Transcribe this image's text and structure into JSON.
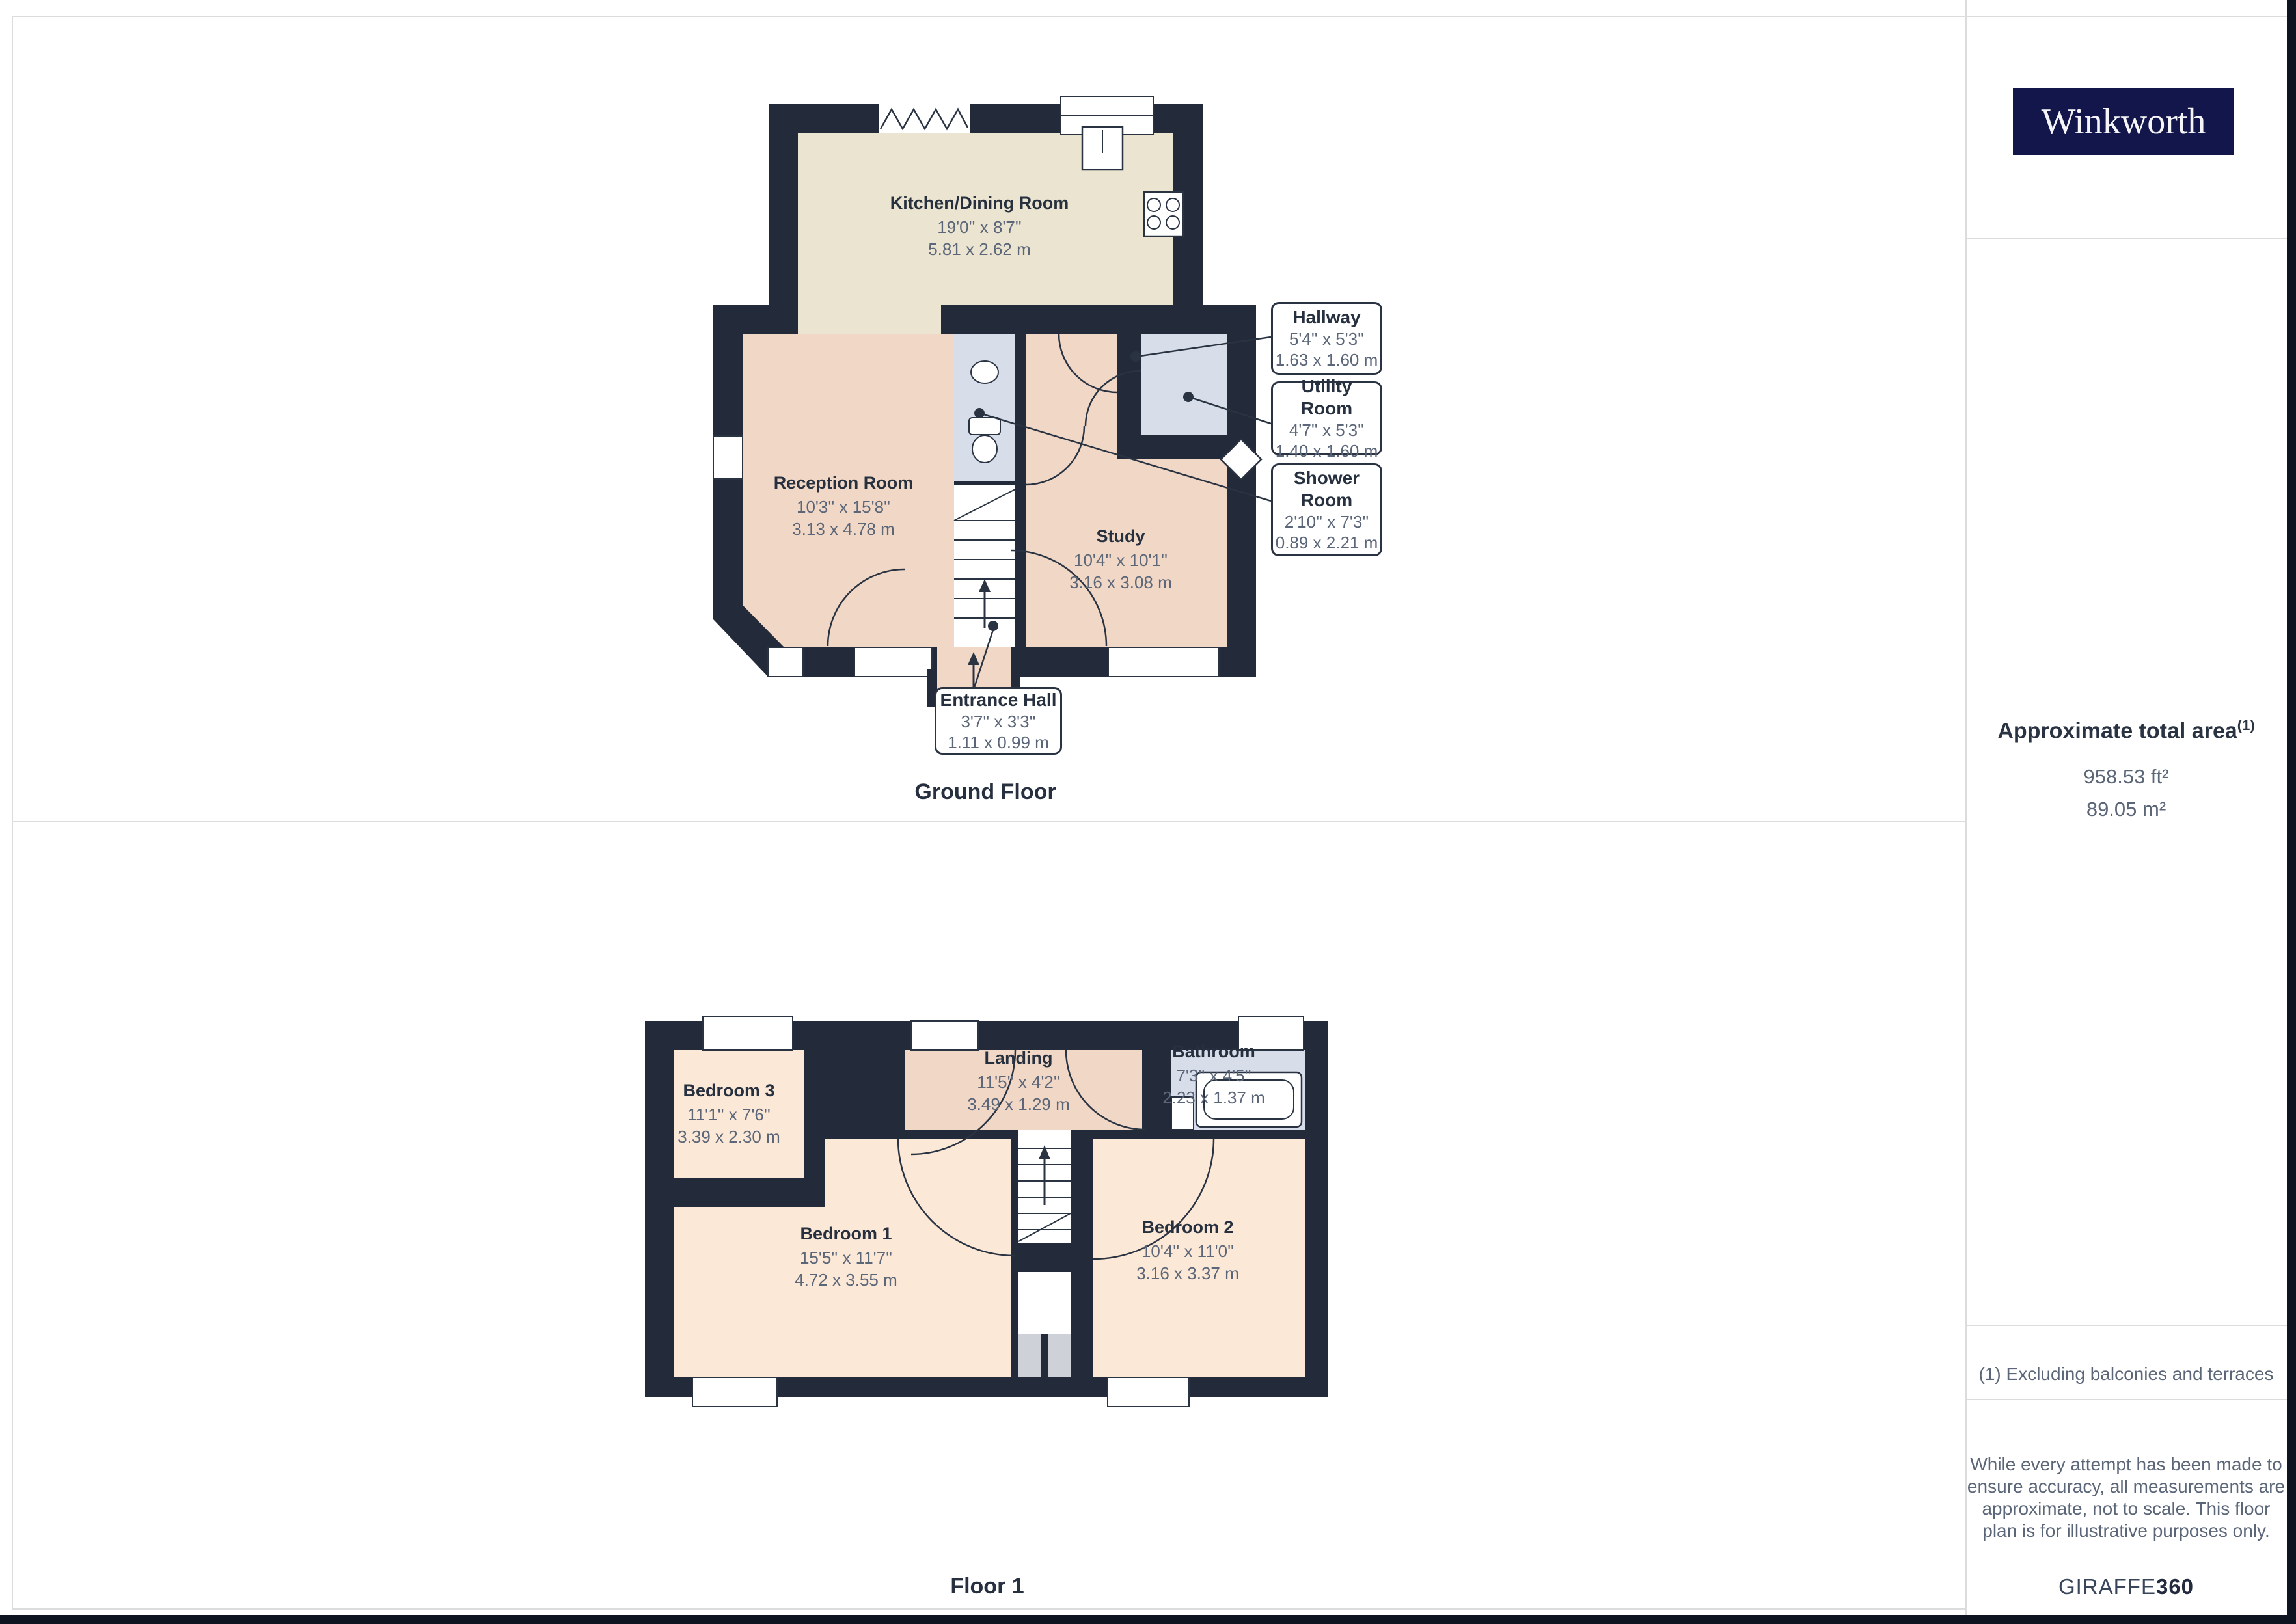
{
  "branding": {
    "logo_text": "Winkworth",
    "provider": "GIRAFFE",
    "provider_bold": "360"
  },
  "sidebar": {
    "total_area": {
      "title": "Approximate total area",
      "superscript": "(1)",
      "ft": "958.53 ft²",
      "m": "89.05 m²"
    },
    "footnote": "(1) Excluding balconies and terraces",
    "disclaimer_lines": [
      "While every attempt has been made to",
      "ensure accuracy, all measurements are",
      "approximate, not to scale. This floor",
      "plan is for illustrative purposes only."
    ]
  },
  "ground_floor": {
    "title": "Ground Floor",
    "rooms": [
      {
        "name": "Kitchen/Dining Room",
        "imperial": "19'0'' x 8'7''",
        "metric": "5.81 x 2.62 m"
      },
      {
        "name": "Reception Room",
        "imperial": "10'3'' x 15'8''",
        "metric": "3.13 x 4.78 m"
      },
      {
        "name": "Study",
        "imperial": "10'4'' x 10'1''",
        "metric": "3.16 x 3.08 m"
      }
    ],
    "callouts": [
      {
        "name": "Hallway",
        "imperial": "5'4'' x 5'3''",
        "metric": "1.63 x 1.60 m"
      },
      {
        "name": "Utility Room",
        "imperial": "4'7'' x 5'3''",
        "metric": "1.40 x 1.60 m"
      },
      {
        "name": "Shower Room",
        "imperial": "2'10'' x 7'3''",
        "metric": "0.89 x 2.21 m"
      },
      {
        "name": "Entrance Hall",
        "imperial": "3'7'' x 3'3''",
        "metric": "1.11 x 0.99 m"
      }
    ]
  },
  "floor1": {
    "title": "Floor 1",
    "rooms": [
      {
        "name": "Bedroom 3",
        "imperial": "11'1'' x 7'6''",
        "metric": "3.39 x 2.30 m"
      },
      {
        "name": "Landing",
        "imperial": "11'5'' x 4'2''",
        "metric": "3.49 x 1.29 m"
      },
      {
        "name": "Bathroom",
        "imperial": "7'3'' x 4'5''",
        "metric": "2.23 x 1.37 m"
      },
      {
        "name": "Bedroom 1",
        "imperial": "15'5'' x 11'7''",
        "metric": "4.72 x 3.55 m"
      },
      {
        "name": "Bedroom 2",
        "imperial": "10'4'' x 11'0''",
        "metric": "3.16 x 3.37 m"
      }
    ]
  },
  "colors": {
    "wall": "#232b3a",
    "kitchen_fill": "#ebe4d1",
    "hall_fill": "#f1d7c6",
    "bedroom_fill": "#fce8d7",
    "wetroom_fill": "#d7dde9",
    "chimney_fill": "#ced1d7",
    "label_dark": "#27303f",
    "label_dim": "#5b6678",
    "divider": "#dcdcdc",
    "edge_strip": "#0e1420",
    "logo_bg": "#13164b"
  }
}
